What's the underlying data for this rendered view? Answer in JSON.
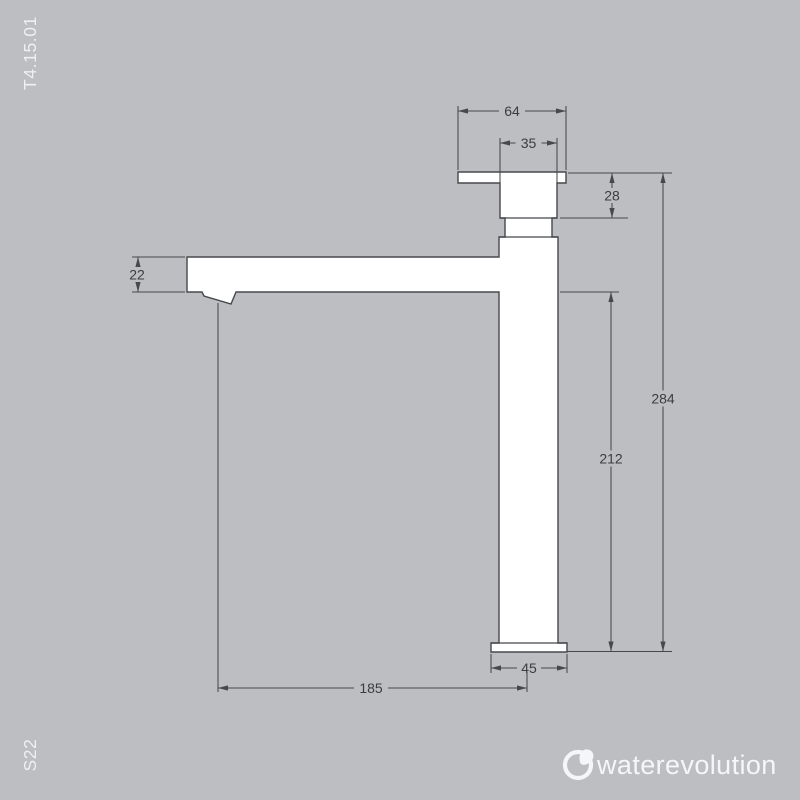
{
  "page": {
    "background_color": "#bcbec2",
    "product_code": "T4.15.01",
    "series_code": "S22"
  },
  "brand": {
    "logo_text": "waterevolution",
    "logo_icon": "drop-in-circle-icon",
    "logo_color": "#f4f6f7"
  },
  "drawing": {
    "subject": "tall single-lever basin mixer, side elevation",
    "line_color": "#46484c",
    "fill_color": "#ffffff",
    "dimensions": {
      "handle_plate_width": "64",
      "handle_width": "35",
      "handle_height": "28",
      "spout_height": "22",
      "total_height": "284",
      "height_below_spout": "212",
      "base_width": "45",
      "spout_reach": "185"
    }
  }
}
